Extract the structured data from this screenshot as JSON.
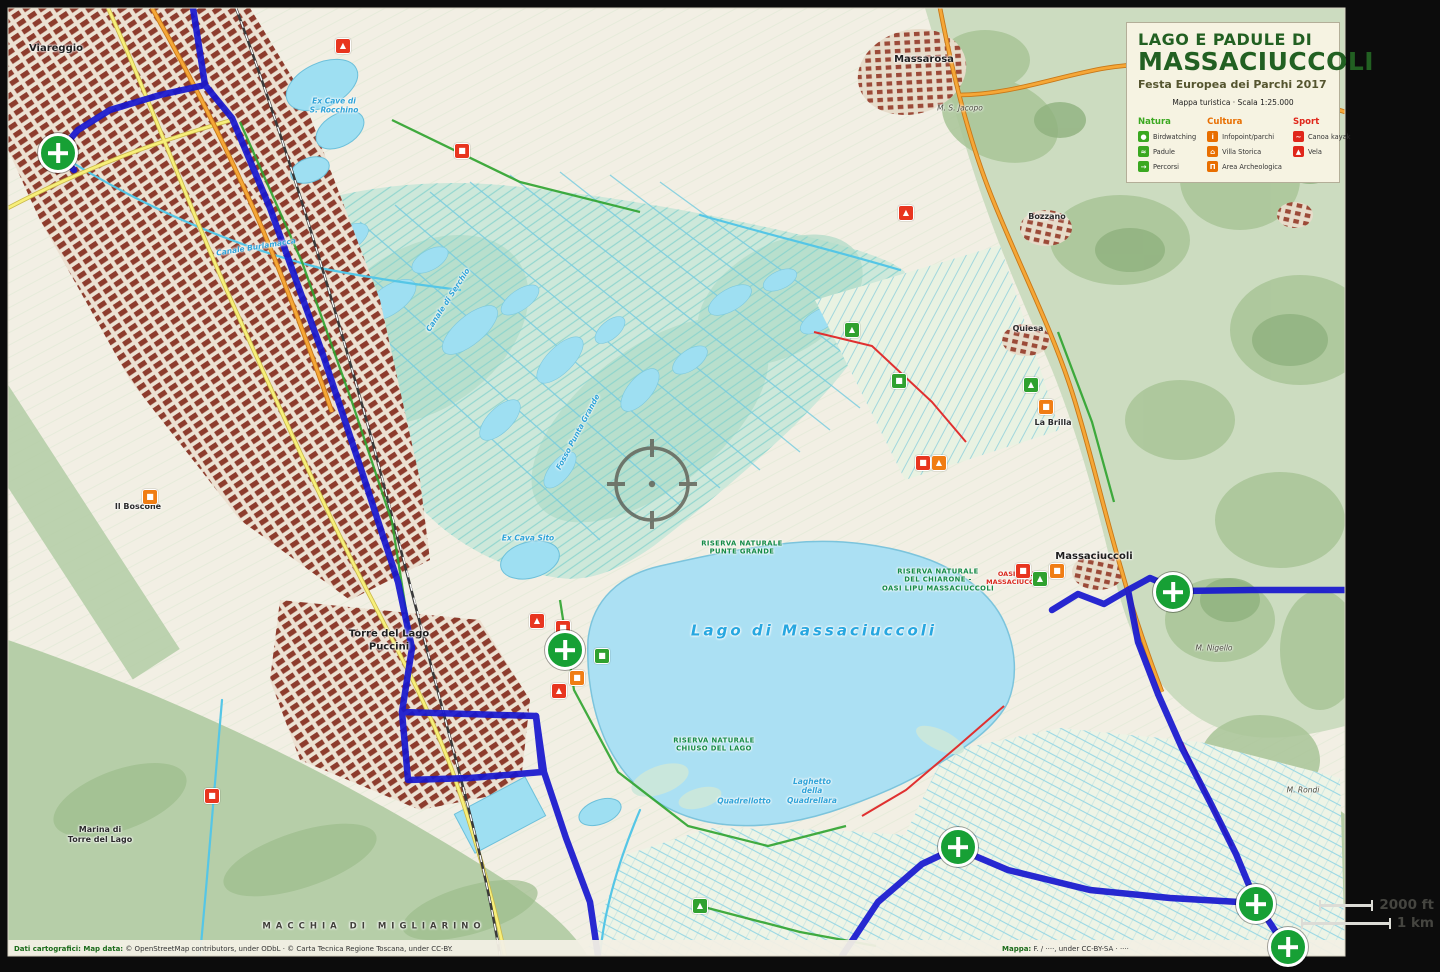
{
  "title_box": {
    "line1": "LAGO E PADULE DI",
    "line2": "MASSACIUCCOLI",
    "subtitle": "Festa Europea dei Parchi 2017",
    "scale_note": "Mappa turistica · Scala 1:25.000"
  },
  "legend": {
    "columns": [
      {
        "name": "Natura",
        "color": "#3aa820",
        "items": [
          {
            "label": "Birdwatching",
            "glyph": "●",
            "icon": "binoculars-icon"
          },
          {
            "label": "Padule",
            "glyph": "≈",
            "icon": "marsh-icon"
          },
          {
            "label": "Percorsi",
            "glyph": "→",
            "icon": "trail-icon"
          }
        ]
      },
      {
        "name": "Cultura",
        "color": "#e86e00",
        "items": [
          {
            "label": "Infopoint/parchi",
            "glyph": "i",
            "icon": "infopoint-icon"
          },
          {
            "label": "Villa Storica",
            "glyph": "⌂",
            "icon": "historic-villa-icon"
          },
          {
            "label": "Area Archeologica",
            "glyph": "Π",
            "icon": "archaeology-icon"
          }
        ]
      },
      {
        "name": "Sport",
        "color": "#e0261a",
        "items": [
          {
            "label": "Canoa kayak",
            "glyph": "~",
            "icon": "canoe-icon"
          },
          {
            "label": "Vela",
            "glyph": "▲",
            "icon": "sail-icon"
          }
        ]
      }
    ]
  },
  "scale_bar": {
    "imperial": "2000 ft",
    "metric": "1 km"
  },
  "attribution": {
    "left_bold": "Dati cartografici: Map data:",
    "left_rest": " © OpenStreetMap contributors, under ODbL · © Carta Tecnica Regione Toscana, under CC-BY.",
    "right_bold": "Mappa:",
    "right_rest": " F. / ····, under CC-BY-SA · ····"
  },
  "poi_colors": {
    "red": "#e8351f",
    "orange": "#f07d14",
    "green": "#2fa12f"
  },
  "route_colors": {
    "bike": "#1717cf",
    "walk": "#2da32d",
    "horse": "#e03030"
  },
  "crosshair": {
    "x": 652,
    "y": 486
  },
  "markers": [
    {
      "x": 58,
      "y": 153
    },
    {
      "x": 565,
      "y": 650
    },
    {
      "x": 1173,
      "y": 592
    },
    {
      "x": 958,
      "y": 847
    },
    {
      "x": 1256,
      "y": 904
    },
    {
      "x": 1288,
      "y": 947
    }
  ],
  "map_labels": [
    {
      "text": "Viareggio",
      "x": 56,
      "y": 49,
      "cls": "town"
    },
    {
      "text": "Ex Cave di\nS. Rocchino",
      "x": 334,
      "y": 106,
      "cls": "water-sm"
    },
    {
      "text": "Massarosa",
      "x": 924,
      "y": 60,
      "cls": "town"
    },
    {
      "text": "M. S. Jacopo",
      "x": 960,
      "y": 108,
      "cls": "hill"
    },
    {
      "text": "Bozzano",
      "x": 1047,
      "y": 217,
      "cls": "town-sm"
    },
    {
      "text": "Quiesa",
      "x": 1028,
      "y": 329,
      "cls": "town-sm"
    },
    {
      "text": "Massaciuccoli",
      "x": 1094,
      "y": 557,
      "cls": "town"
    },
    {
      "text": "Torre del Lago\nPuccini",
      "x": 389,
      "y": 641,
      "cls": "town"
    },
    {
      "text": "Il Boscone",
      "x": 138,
      "y": 507,
      "cls": "town-sm"
    },
    {
      "text": "Lago di Massaciuccoli",
      "x": 814,
      "y": 631,
      "cls": "lake"
    },
    {
      "text": "Riserva Naturale\nPunte Grande",
      "x": 742,
      "y": 548,
      "cls": "reserve"
    },
    {
      "text": "Riserva Naturale\ndel Chiarone -\nOasi LIPU Massaciuccoli",
      "x": 938,
      "y": 580,
      "cls": "reserve"
    },
    {
      "text": "Oasi LIPU\nMassaciuccoli",
      "x": 1016,
      "y": 578,
      "cls": "reserve-red"
    },
    {
      "text": "Riserva Naturale\nChiuso del Lago",
      "x": 714,
      "y": 745,
      "cls": "reserve"
    },
    {
      "text": "Quadrellotto",
      "x": 744,
      "y": 801,
      "cls": "water-sm"
    },
    {
      "text": "Laghetto\ndella\nQuadrellara",
      "x": 812,
      "y": 791,
      "cls": "water-sm"
    },
    {
      "text": "MACCHIA DI MIGLIARINO",
      "x": 374,
      "y": 927,
      "cls": "forest"
    },
    {
      "text": "Ex Cava Sito",
      "x": 528,
      "y": 538,
      "cls": "water-sm"
    },
    {
      "text": "Canale di Serchio",
      "x": 448,
      "y": 300,
      "cls": "water-sm",
      "rot": -57
    },
    {
      "text": "Fosso Punta Grande",
      "x": 578,
      "y": 432,
      "cls": "water-sm",
      "rot": -62
    },
    {
      "text": "Canale Burlamacca",
      "x": 256,
      "y": 247,
      "cls": "water-sm",
      "rot": -9
    },
    {
      "text": "Marina di\nTorre del Lago",
      "x": 100,
      "y": 835,
      "cls": "town-sm"
    },
    {
      "text": "M. Nigello",
      "x": 1214,
      "y": 648,
      "cls": "hill"
    },
    {
      "text": "M. Rondi",
      "x": 1303,
      "y": 790,
      "cls": "hill"
    },
    {
      "text": "La Brilla",
      "x": 1053,
      "y": 423,
      "cls": "town-sm"
    }
  ],
  "pois": [
    {
      "x": 343,
      "y": 46,
      "c": "red",
      "g": "▲"
    },
    {
      "x": 462,
      "y": 151,
      "c": "red",
      "g": "■"
    },
    {
      "x": 906,
      "y": 213,
      "c": "red",
      "g": "▲"
    },
    {
      "x": 852,
      "y": 330,
      "c": "green",
      "g": "▲"
    },
    {
      "x": 899,
      "y": 381,
      "c": "green",
      "g": "■"
    },
    {
      "x": 1031,
      "y": 385,
      "c": "green",
      "g": "▲"
    },
    {
      "x": 1046,
      "y": 407,
      "c": "orange",
      "g": "■"
    },
    {
      "x": 939,
      "y": 463,
      "c": "orange",
      "g": "▲"
    },
    {
      "x": 923,
      "y": 463,
      "c": "red",
      "g": "■"
    },
    {
      "x": 1023,
      "y": 571,
      "c": "red",
      "g": "■"
    },
    {
      "x": 1040,
      "y": 579,
      "c": "green",
      "g": "▲"
    },
    {
      "x": 1057,
      "y": 571,
      "c": "orange",
      "g": "■"
    },
    {
      "x": 537,
      "y": 621,
      "c": "red",
      "g": "▲"
    },
    {
      "x": 563,
      "y": 628,
      "c": "red",
      "g": "■"
    },
    {
      "x": 577,
      "y": 678,
      "c": "orange",
      "g": "■"
    },
    {
      "x": 559,
      "y": 691,
      "c": "red",
      "g": "▲"
    },
    {
      "x": 150,
      "y": 497,
      "c": "orange",
      "g": "■"
    },
    {
      "x": 212,
      "y": 796,
      "c": "red",
      "g": "■"
    },
    {
      "x": 700,
      "y": 906,
      "c": "green",
      "g": "▲"
    },
    {
      "x": 602,
      "y": 656,
      "c": "green",
      "g": "■"
    }
  ]
}
